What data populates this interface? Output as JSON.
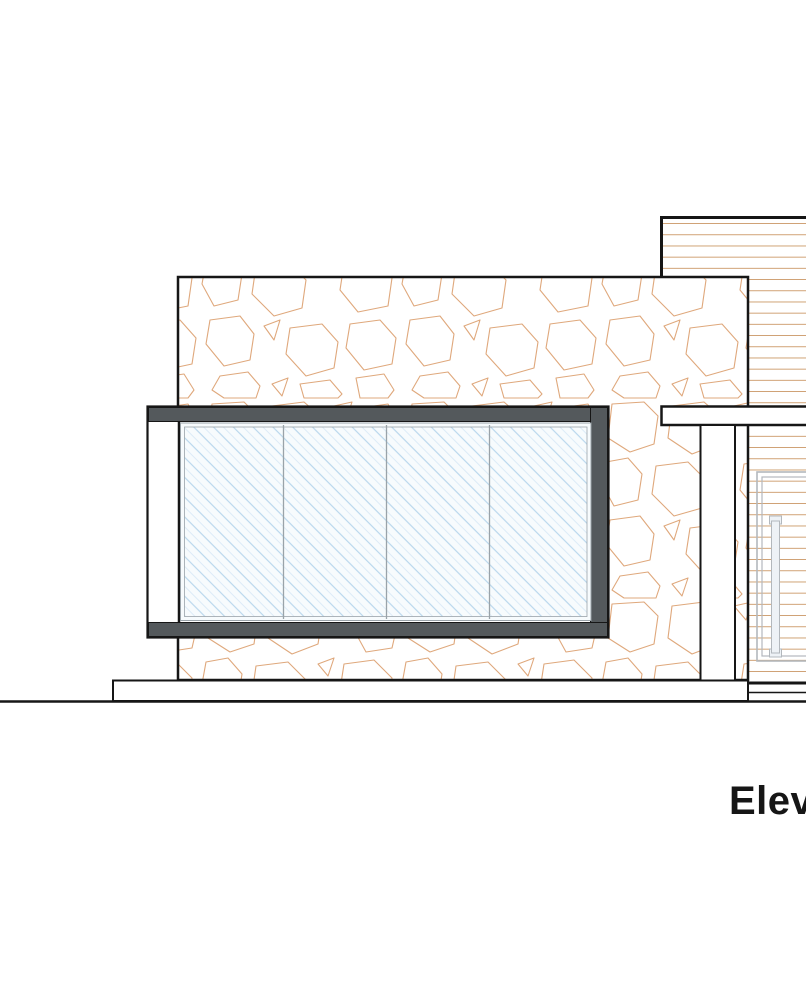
{
  "title": {
    "text": "Elev"
  },
  "drawing": {
    "kind": "architectural-elevation",
    "elements": {
      "stone_wall": "rubble stone masonry wall",
      "corner_window": "dark framed corner window, 4 glazed panels",
      "siding_volume": "rear volume with horizontal wood siding",
      "canopy_beam": "horizontal fascia beam",
      "column": "white post under beam",
      "entry_door": "sided door with vertical pull handle",
      "plinth": "base plinth",
      "ground": "ground line"
    },
    "window_panel_count": 4
  },
  "colors": {
    "line-black": "#161616",
    "stone-line": "#dfa87c",
    "siding-line": "#c9935f",
    "frame-gray": "#54595c",
    "glass-bg": "#f7fbfd",
    "glass-hatch": "#b9d7ec",
    "glass-hatch-light": "#dcebf7",
    "glass-edge": "#9aa3a9",
    "door-line": "#b3b8bd",
    "handle-fill": "#eef2f6",
    "paper": "#ffffff"
  }
}
